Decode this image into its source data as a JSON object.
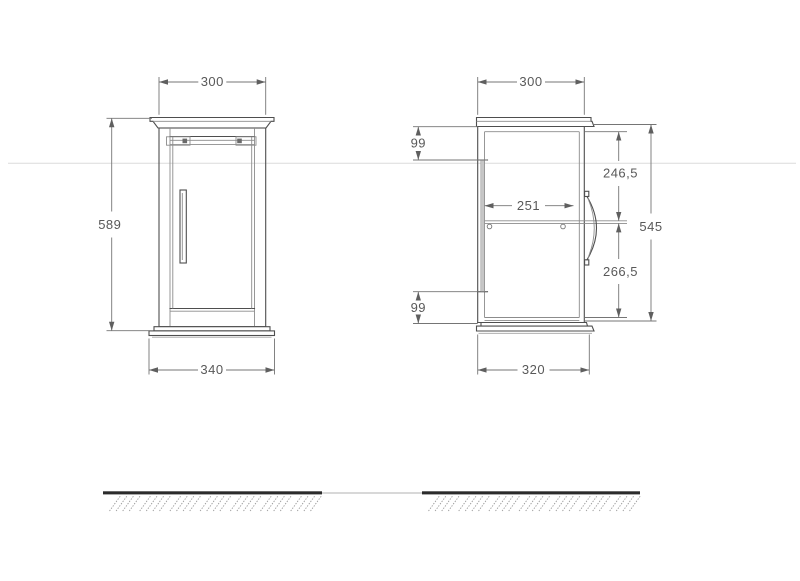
{
  "drawing": {
    "kind": "furniture-technical-drawing",
    "views": {
      "front": {
        "dims": {
          "top_width": "300",
          "height": "589",
          "base_width": "340"
        }
      },
      "side": {
        "dims": {
          "top_depth": "300",
          "back_offset_top": "99",
          "upper_inner": "246,5",
          "shelf_depth": "251",
          "carcass_height": "545",
          "lower_inner": "266,5",
          "back_offset_bottom": "99",
          "base_depth": "320"
        }
      }
    },
    "colors": {
      "outline": "#4e4e4e",
      "inner_line": "#8c8c8c",
      "dim_line": "#757575",
      "dim_text": "#595959",
      "ground": "#2b2b2b",
      "hatch": "#9a9a9a",
      "guide_line": "#dcdcdc",
      "panel_fill": "#c6c6c6"
    }
  }
}
